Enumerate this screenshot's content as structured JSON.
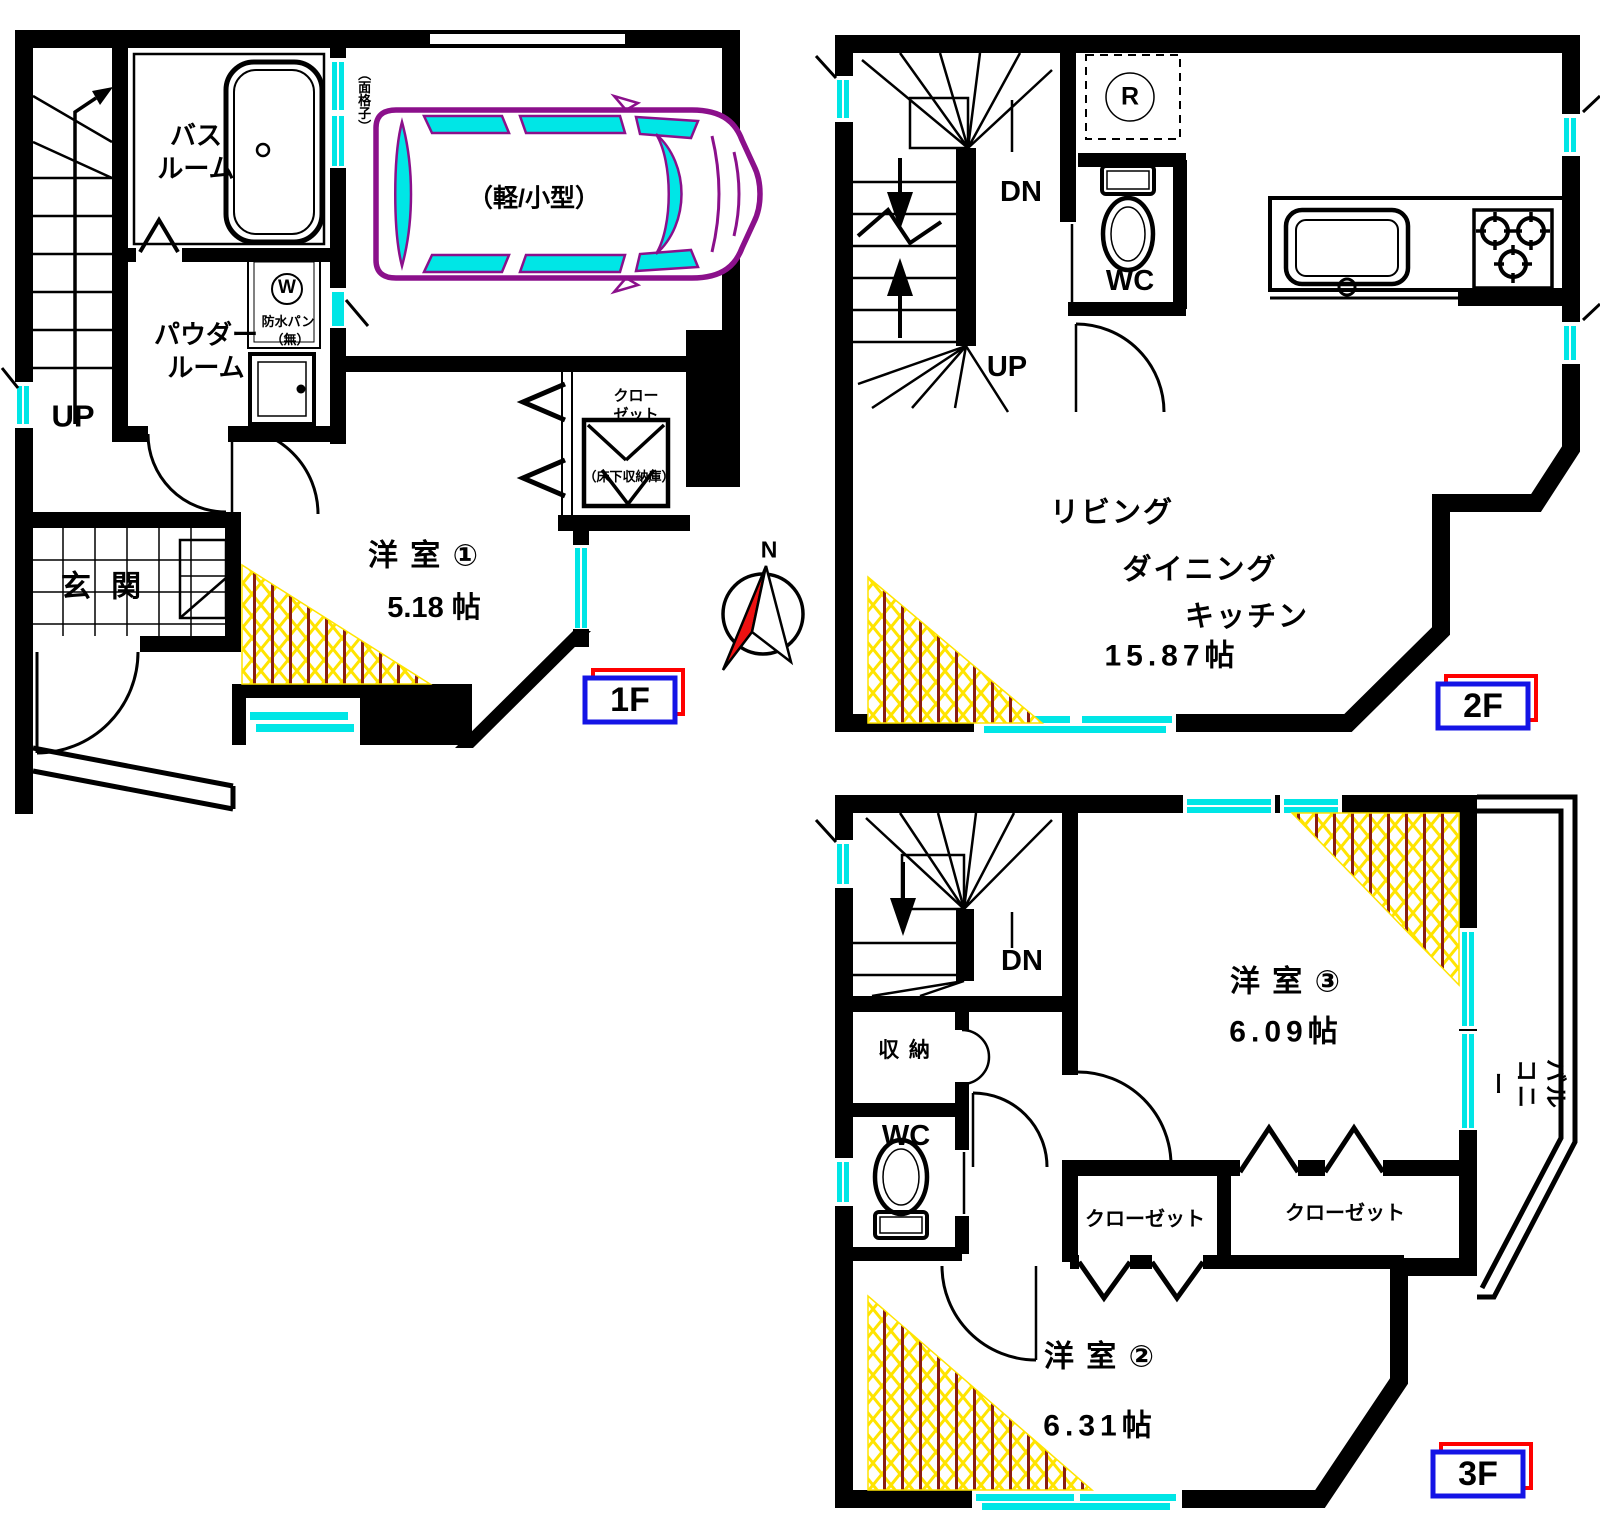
{
  "floor1": {
    "badge": "1F",
    "stairs_up": "UP",
    "bathroom": "バス\nルーム",
    "powder_room": "パウダー\nルーム",
    "entrance": "玄 関",
    "room1_label": "洋 室 ①",
    "room1_area": "5.18 帖",
    "closet": "クロー\nゼット",
    "underfloor_storage": "（床下収納庫）",
    "washer_symbol": "W",
    "washer_pan": "防水パン",
    "washer_pan_none": "（無）",
    "window_grille": "（面格子）",
    "car_space": "（軽/小型）",
    "compass_north": "N"
  },
  "floor2": {
    "badge": "2F",
    "stairs_down": "DN",
    "stairs_up": "UP",
    "refrigerator_symbol": "R",
    "wc": "WC",
    "ldk_line1": "リビング",
    "ldk_line2": "ダイニング",
    "ldk_line3": "キッチン",
    "ldk_area": "15.87帖"
  },
  "floor3": {
    "badge": "3F",
    "stairs_down": "DN",
    "storage": "収 納",
    "wc": "WC",
    "room3_label": "洋 室 ③",
    "room3_area": "6.09帖",
    "closet_left": "クローゼット",
    "closet_right": "クローゼット",
    "room2_label": "洋 室 ②",
    "room2_area": "6.31帖",
    "balcony": "バルコニー"
  },
  "colors": {
    "wall": "#000000",
    "window": "#00e6e6",
    "car_outline": "#8b108b",
    "hatch_yellow": "#ffe400",
    "hatch_red": "#8b1d12",
    "badge_blue": "#1414e6",
    "badge_red": "#ff0000",
    "compass_red": "#ee1111"
  }
}
